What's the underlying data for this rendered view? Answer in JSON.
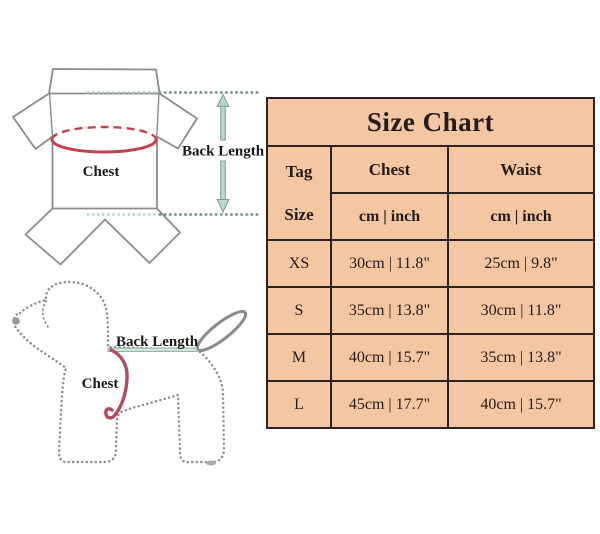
{
  "measurement_guide": {
    "garment": {
      "chest_label": "Chest",
      "back_length_label": "Back Length"
    },
    "dog": {
      "chest_label": "Chest",
      "back_length_label": "Back Length"
    }
  },
  "size_chart": {
    "title": "Size Chart",
    "tag_size_header": {
      "line1": "Tag",
      "line2": "Size"
    },
    "measure_columns": [
      {
        "label": "Chest",
        "unit": "cm | inch"
      },
      {
        "label": "Waist",
        "unit": "cm | inch"
      }
    ],
    "rows": [
      {
        "tag": "XS",
        "chest": "30cm | 11.8\"",
        "waist": "25cm | 9.8\""
      },
      {
        "tag": "S",
        "chest": "35cm | 13.8\"",
        "waist": "30cm | 11.8\""
      },
      {
        "tag": "M",
        "chest": "40cm | 15.7\"",
        "waist": "35cm | 13.8\""
      },
      {
        "tag": "L",
        "chest": "45cm | 17.7\"",
        "waist": "40cm | 15.7\""
      }
    ]
  },
  "colors": {
    "table_background": "#f4c7a2",
    "table_border": "#2b2323",
    "measure_red": "#c5404f",
    "dog_measure_red": "#b34b5f",
    "arrow_teal_fill": "#bdd8cb",
    "arrow_teal_border": "#74a08e",
    "outline_gray": "#8b8b8b"
  }
}
